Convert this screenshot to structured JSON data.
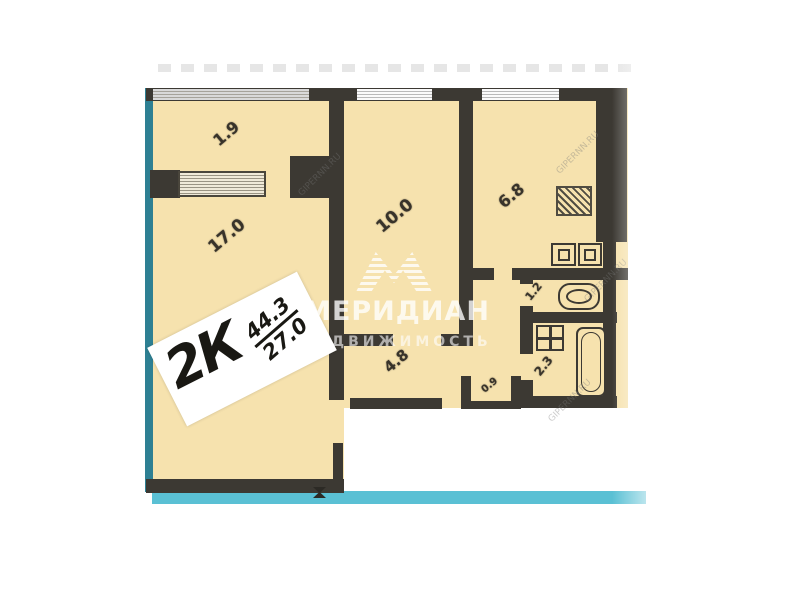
{
  "page": {
    "background": "#ffffff"
  },
  "plan": {
    "type_label": "2К",
    "area_total": "44.3",
    "area_living": "27.0",
    "rooms": [
      {
        "name": "balcony",
        "area": "1.9"
      },
      {
        "name": "living-room",
        "area": "17.0"
      },
      {
        "name": "bedroom",
        "area": "10.0"
      },
      {
        "name": "kitchen",
        "area": "6.8"
      },
      {
        "name": "hallway",
        "area": "4.8"
      },
      {
        "name": "wc",
        "area": "1.2"
      },
      {
        "name": "bathroom",
        "area": "2.3"
      },
      {
        "name": "closet",
        "area": "0.9"
      }
    ],
    "watermark": {
      "brand": "МЕРИДИАН",
      "subtitle": "НЕДВИЖИМОСТЬ",
      "site": "GIPERNN.RU"
    },
    "colors": {
      "room_fill": "#f6e2ae",
      "wall": "#3c3933",
      "exterior_line": "#2e8093",
      "exterior_band": "#5ac0d4",
      "label": "#38332a",
      "sticker_bg": "#ffffff",
      "sticker_text": "#191813"
    }
  }
}
